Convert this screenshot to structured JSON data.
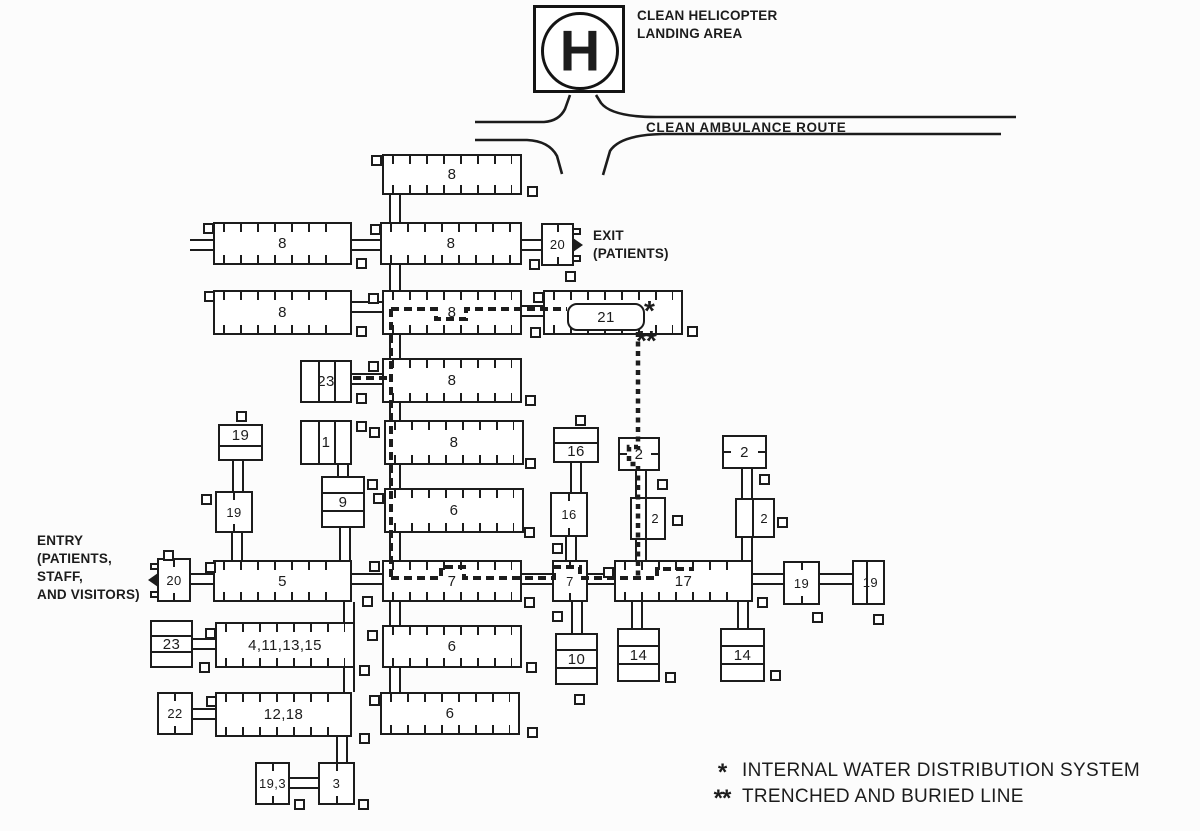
{
  "ink": "#1c1c1c",
  "helipad": {
    "symbol": "H",
    "label_lines": [
      "CLEAN HELICOPTER",
      "LANDING AREA"
    ]
  },
  "ambulance_route_label": "CLEAN AMBULANCE ROUTE",
  "exit_label_lines": [
    "EXIT",
    "(PATIENTS)"
  ],
  "entry_label_lines": [
    "ENTRY",
    "(PATIENTS,",
    "STAFF,",
    "AND VISITORS)"
  ],
  "legend": {
    "items": [
      {
        "marker": "*",
        "text": "INTERNAL WATER DISTRIBUTION SYSTEM"
      },
      {
        "marker": "**",
        "text": "TRENCHED AND BURIED LINE"
      }
    ]
  },
  "water_markers": {
    "internal": "*",
    "buried": "**"
  },
  "buildings": [
    {
      "label": "8",
      "x": 382,
      "y": 154,
      "w": 140,
      "h": 41,
      "style": "ticks"
    },
    {
      "label": "8",
      "x": 213,
      "y": 222,
      "w": 139,
      "h": 43,
      "style": "ticks"
    },
    {
      "label": "8",
      "x": 380,
      "y": 222,
      "w": 142,
      "h": 43,
      "style": "ticks"
    },
    {
      "label": "20",
      "x": 541,
      "y": 223,
      "w": 33,
      "h": 43,
      "style": "ctick",
      "door": "right"
    },
    {
      "label": "8",
      "x": 213,
      "y": 290,
      "w": 139,
      "h": 45,
      "style": "ticks"
    },
    {
      "label": "8",
      "x": 382,
      "y": 290,
      "w": 140,
      "h": 45,
      "style": "ticks"
    },
    {
      "label": "21",
      "x": 543,
      "y": 290,
      "w": 140,
      "h": 45,
      "style": "ticks",
      "tank": true
    },
    {
      "label": "23",
      "x": 300,
      "y": 360,
      "w": 52,
      "h": 43,
      "style": "vdiv"
    },
    {
      "label": "8",
      "x": 382,
      "y": 358,
      "w": 140,
      "h": 45,
      "style": "ticks"
    },
    {
      "label": "1",
      "x": 300,
      "y": 420,
      "w": 52,
      "h": 45,
      "style": "vdiv"
    },
    {
      "label": "8",
      "x": 384,
      "y": 420,
      "w": 140,
      "h": 45,
      "style": "ticks"
    },
    {
      "label": "19",
      "x": 218,
      "y": 424,
      "w": 45,
      "h": 37,
      "style": "hdiv",
      "label_pos": "top"
    },
    {
      "label": "19",
      "x": 215,
      "y": 491,
      "w": 38,
      "h": 42,
      "style": "ctick"
    },
    {
      "label": "9",
      "x": 321,
      "y": 476,
      "w": 44,
      "h": 52,
      "style": "hdiv2"
    },
    {
      "label": "6",
      "x": 384,
      "y": 488,
      "w": 140,
      "h": 45,
      "style": "ticks"
    },
    {
      "label": "16",
      "x": 553,
      "y": 427,
      "w": 46,
      "h": 36,
      "style": "hdiv",
      "label_pos": "bottom"
    },
    {
      "label": "16",
      "x": 550,
      "y": 492,
      "w": 38,
      "h": 45,
      "style": "ctick"
    },
    {
      "label": "2",
      "x": 618,
      "y": 437,
      "w": 42,
      "h": 34,
      "style": "sideticks"
    },
    {
      "label": "2",
      "x": 630,
      "y": 497,
      "w": 36,
      "h": 43,
      "style": "vdiv1"
    },
    {
      "label": "2",
      "x": 722,
      "y": 435,
      "w": 45,
      "h": 34,
      "style": "sideticks"
    },
    {
      "label": "2",
      "x": 735,
      "y": 498,
      "w": 40,
      "h": 40,
      "style": "vdiv1"
    },
    {
      "label": "20",
      "x": 157,
      "y": 558,
      "w": 34,
      "h": 44,
      "style": "ctick",
      "door": "left"
    },
    {
      "label": "5",
      "x": 213,
      "y": 560,
      "w": 139,
      "h": 42,
      "style": "ticks"
    },
    {
      "label": "7",
      "x": 382,
      "y": 560,
      "w": 140,
      "h": 42,
      "style": "ticks"
    },
    {
      "label": "7",
      "x": 552,
      "y": 560,
      "w": 36,
      "h": 42,
      "style": "ctick"
    },
    {
      "label": "17",
      "x": 614,
      "y": 560,
      "w": 139,
      "h": 42,
      "style": "ticks"
    },
    {
      "label": "19",
      "x": 783,
      "y": 561,
      "w": 37,
      "h": 44,
      "style": "ctick"
    },
    {
      "label": "19",
      "x": 852,
      "y": 560,
      "w": 33,
      "h": 45,
      "style": "vdiv1"
    },
    {
      "label": "23",
      "x": 150,
      "y": 620,
      "w": 43,
      "h": 48,
      "style": "hdiv2"
    },
    {
      "label": "4,11,13,15",
      "x": 215,
      "y": 622,
      "w": 140,
      "h": 46,
      "style": "ticks"
    },
    {
      "label": "6",
      "x": 382,
      "y": 625,
      "w": 140,
      "h": 43,
      "style": "ticks"
    },
    {
      "label": "10",
      "x": 555,
      "y": 633,
      "w": 43,
      "h": 52,
      "style": "hdiv2"
    },
    {
      "label": "14",
      "x": 617,
      "y": 628,
      "w": 43,
      "h": 54,
      "style": "hdiv2"
    },
    {
      "label": "14",
      "x": 720,
      "y": 628,
      "w": 45,
      "h": 54,
      "style": "hdiv2"
    },
    {
      "label": "22",
      "x": 157,
      "y": 692,
      "w": 36,
      "h": 43,
      "style": "ctick"
    },
    {
      "label": "12,18",
      "x": 215,
      "y": 692,
      "w": 137,
      "h": 45,
      "style": "ticks"
    },
    {
      "label": "6",
      "x": 380,
      "y": 692,
      "w": 140,
      "h": 43,
      "style": "ticks"
    },
    {
      "label": "19,3",
      "x": 255,
      "y": 762,
      "w": 35,
      "h": 43,
      "style": "ctick"
    },
    {
      "label": "3",
      "x": 318,
      "y": 762,
      "w": 37,
      "h": 43,
      "style": "ctick"
    }
  ],
  "tank": {
    "rel_x": 22,
    "rel_y": 11,
    "w": 78,
    "h": 28
  },
  "corridors": {
    "vertical": [
      [
        389,
        195,
        27
      ],
      [
        389,
        265,
        25
      ],
      [
        389,
        335,
        23
      ],
      [
        389,
        403,
        17
      ],
      [
        389,
        465,
        23
      ],
      [
        389,
        533,
        27
      ],
      [
        389,
        602,
        23
      ],
      [
        389,
        668,
        24
      ],
      [
        343,
        602,
        20
      ],
      [
        343,
        668,
        24
      ],
      [
        336,
        737,
        25
      ],
      [
        232,
        461,
        30
      ],
      [
        231,
        533,
        27
      ],
      [
        337,
        465,
        11
      ],
      [
        339,
        528,
        32
      ],
      [
        570,
        463,
        29
      ],
      [
        565,
        537,
        23
      ],
      [
        635,
        471,
        26
      ],
      [
        635,
        540,
        20
      ],
      [
        741,
        469,
        29
      ],
      [
        741,
        538,
        22
      ],
      [
        571,
        602,
        31
      ],
      [
        631,
        602,
        26
      ],
      [
        737,
        602,
        26
      ]
    ],
    "horizontal": [
      [
        352,
        239,
        30
      ],
      [
        190,
        239,
        23
      ],
      [
        522,
        239,
        19
      ],
      [
        352,
        301,
        30
      ],
      [
        522,
        305,
        21
      ],
      [
        352,
        373,
        30
      ],
      [
        191,
        573,
        22
      ],
      [
        352,
        573,
        30
      ],
      [
        522,
        573,
        30
      ],
      [
        588,
        573,
        26
      ],
      [
        753,
        573,
        30
      ],
      [
        820,
        573,
        32
      ],
      [
        193,
        638,
        22
      ],
      [
        193,
        708,
        22
      ],
      [
        290,
        777,
        28
      ]
    ]
  },
  "utility_squares": [
    [
      371,
      155
    ],
    [
      527,
      186
    ],
    [
      203,
      223
    ],
    [
      370,
      224
    ],
    [
      356,
      258
    ],
    [
      529,
      259
    ],
    [
      565,
      271
    ],
    [
      204,
      291
    ],
    [
      368,
      293
    ],
    [
      533,
      292
    ],
    [
      356,
      326
    ],
    [
      530,
      327
    ],
    [
      687,
      326
    ],
    [
      368,
      361
    ],
    [
      356,
      393
    ],
    [
      525,
      395
    ],
    [
      356,
      421
    ],
    [
      369,
      427
    ],
    [
      236,
      411
    ],
    [
      201,
      494
    ],
    [
      367,
      479
    ],
    [
      373,
      493
    ],
    [
      525,
      458
    ],
    [
      524,
      527
    ],
    [
      575,
      415
    ],
    [
      657,
      479
    ],
    [
      672,
      515
    ],
    [
      759,
      474
    ],
    [
      777,
      517
    ],
    [
      552,
      543
    ],
    [
      163,
      550
    ],
    [
      205,
      562
    ],
    [
      369,
      561
    ],
    [
      362,
      596
    ],
    [
      524,
      597
    ],
    [
      603,
      567
    ],
    [
      757,
      597
    ],
    [
      552,
      611
    ],
    [
      812,
      612
    ],
    [
      873,
      614
    ],
    [
      205,
      628
    ],
    [
      199,
      662
    ],
    [
      367,
      630
    ],
    [
      359,
      665
    ],
    [
      369,
      695
    ],
    [
      206,
      696
    ],
    [
      359,
      733
    ],
    [
      526,
      662
    ],
    [
      527,
      727
    ],
    [
      574,
      694
    ],
    [
      665,
      672
    ],
    [
      770,
      670
    ],
    [
      294,
      799
    ],
    [
      358,
      799
    ]
  ],
  "water_lines": {
    "internal": [
      "M 391 309 H 436 V 319 H 466 V 309 H 567",
      "M 391 309 V 578",
      "M 353 378 H 391",
      "M 391 578 H 441 V 567 H 464 V 578 H 554 V 567 H 580 V 578 H 657 V 569 H 694"
    ],
    "buried": [
      "M 638 332 V 447 H 629 V 464 H 638 V 578"
    ]
  }
}
